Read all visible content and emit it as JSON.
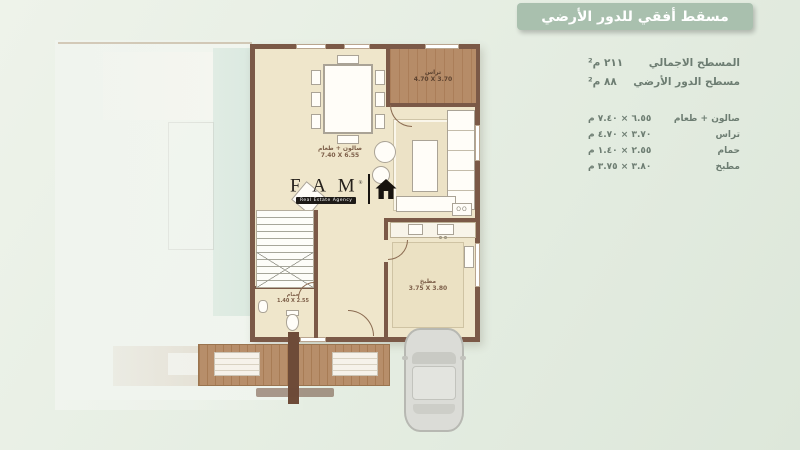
{
  "banner": {
    "title": "مسقط أفقي للدور الأرضي"
  },
  "info": {
    "areas": [
      {
        "label": "المسطح الاجمالي",
        "value": "٢١١ م²"
      },
      {
        "label": "مسطح الدور الأرضي",
        "value": "٨٨ م²"
      }
    ],
    "rooms": [
      {
        "label": "صالون + طعام",
        "value": "٦.٥٥ × ٧.٤٠ م"
      },
      {
        "label": "تراس",
        "value": "٣.٧٠ × ٤.٧٠ م"
      },
      {
        "label": "حمام",
        "value": "٢.٥٥ × ١.٤٠ م"
      },
      {
        "label": "مطبخ",
        "value": "٣.٨٠ × ٣.٧٥ م"
      }
    ]
  },
  "plan": {
    "salon": {
      "name": "صالون + طعام",
      "dims": "7.40 X 6.55"
    },
    "terrace": {
      "name": "تراس",
      "dims": "4.70 X 3.70"
    },
    "bath": {
      "name": "حمام",
      "dims": "1.40 X 2.55"
    },
    "kitchen": {
      "name": "مطبخ",
      "dims": "3.75 X 3.80"
    }
  },
  "logo": {
    "letters": "F A M",
    "reg": "®",
    "tagline": "Real Estate Agency"
  },
  "colors": {
    "background": "#e6eee3",
    "banner": "#a9c0ae",
    "info_text": "#6d7d72",
    "wall": "#7b5947",
    "floor": "#efe6cb",
    "wood": "#b68c68",
    "ghost_overlay": "#cbe0d5",
    "car": "#dbdcd7"
  }
}
